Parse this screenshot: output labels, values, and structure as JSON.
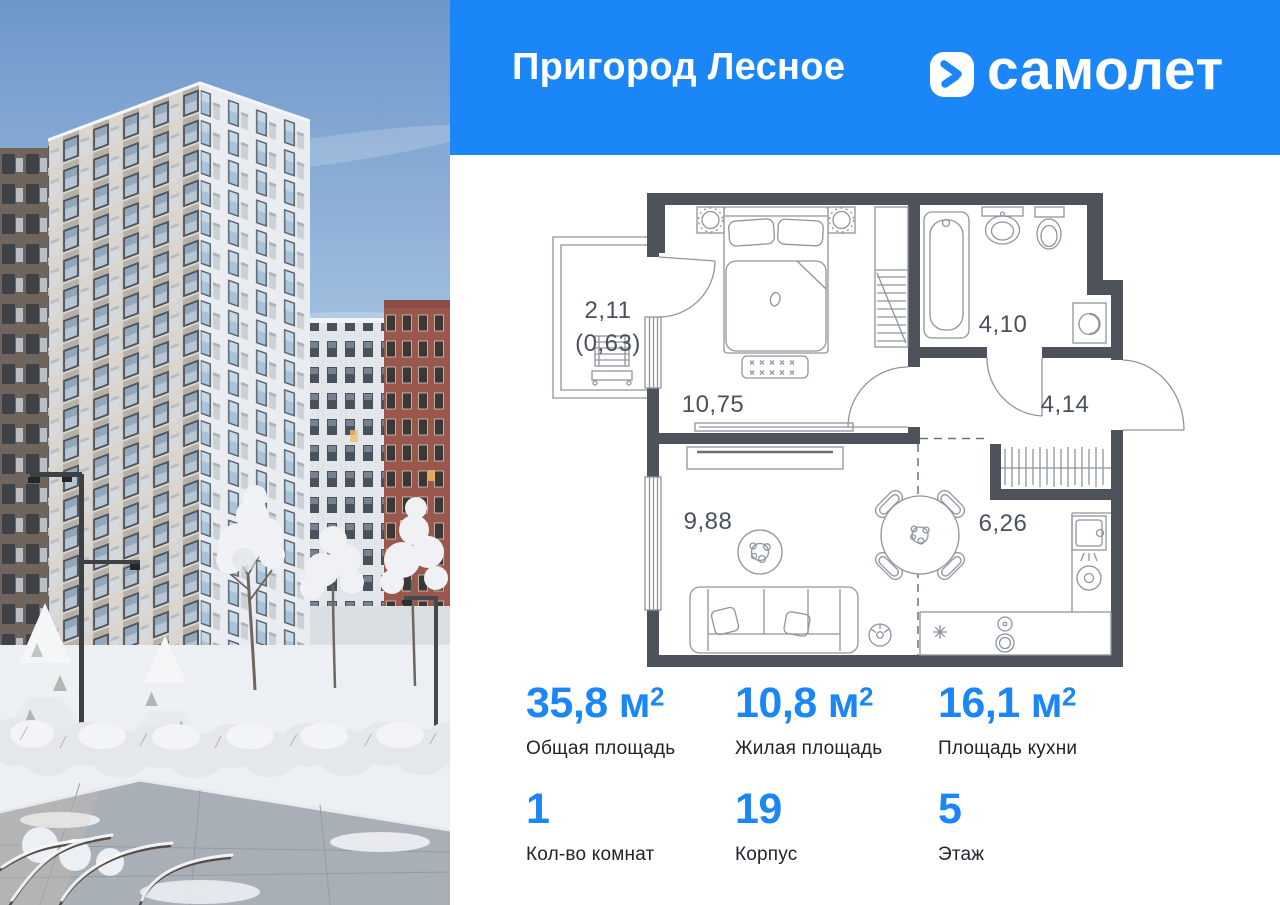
{
  "header": {
    "title": "Пригород Лесное",
    "brand": "самолет",
    "logo_icon": "samolet-arrow-chevron-icon"
  },
  "floor_plan": {
    "rooms": [
      {
        "name": "loggia",
        "area": "2,11",
        "area_coef": "(0,63)"
      },
      {
        "name": "bedroom",
        "area": "10,75"
      },
      {
        "name": "bathroom",
        "area": "4,10"
      },
      {
        "name": "hallway",
        "area": "4,14"
      },
      {
        "name": "living-room",
        "area": "9,88"
      },
      {
        "name": "kitchen",
        "area": "6,26"
      }
    ]
  },
  "stats": [
    {
      "value": "35,8",
      "unit": "м",
      "sup": "2",
      "label": "Общая площадь"
    },
    {
      "value": "10,8",
      "unit": "м",
      "sup": "2",
      "label": "Жилая площадь"
    },
    {
      "value": "16,1",
      "unit": "м",
      "sup": "2",
      "label": "Площадь кухни"
    },
    {
      "value": "1",
      "unit": "",
      "sup": "",
      "label": "Кол-во комнат"
    },
    {
      "value": "19",
      "unit": "",
      "sup": "",
      "label": "Корпус"
    },
    {
      "value": "5",
      "unit": "",
      "sup": "",
      "label": "Этаж"
    }
  ],
  "colors": {
    "accent": "#1a86f8",
    "wall": "#4d525b",
    "line": "#8f959e",
    "label": "#4b515c"
  }
}
